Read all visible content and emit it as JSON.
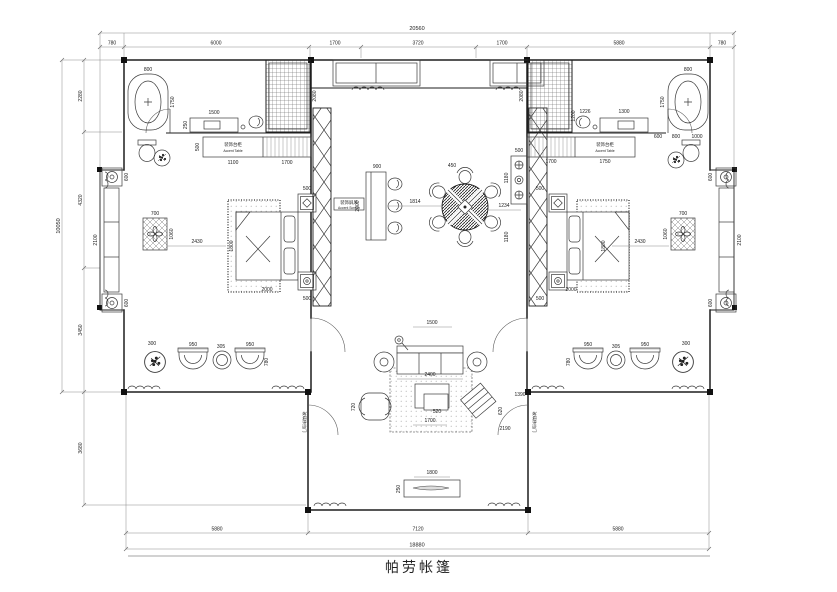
{
  "title": "帕劳帐篷",
  "dimensions": {
    "top_total": "20560",
    "top_segments": [
      "780",
      "6000",
      "1700",
      "3720",
      "1700",
      "5880",
      "780"
    ],
    "bottom_segments": [
      "5880",
      "7120",
      "5880"
    ],
    "bottom_total": "18880",
    "left_segments": [
      "2280",
      "4320",
      "3450",
      "3680"
    ],
    "left_total": "10050"
  },
  "labels": {
    "accent_table_cn": "装饰台柜",
    "accent_table_en": "Accent Table",
    "accent_screen_cn": "装饰屏风",
    "accent_screen_en": "Accent Screen",
    "glass_door": "玻璃移拉门"
  },
  "plan_dims": [
    "800",
    "1750",
    "1500",
    "250",
    "1100",
    "1700",
    "500",
    "2080",
    "700",
    "1060",
    "2430",
    "1800",
    "2000",
    "500",
    "500",
    "2100",
    "600",
    "600",
    "950",
    "305",
    "950",
    "780",
    "300",
    "900",
    "2000",
    "1814",
    "450",
    "1234",
    "500",
    "1180",
    "1180",
    "1500",
    "2400",
    "520",
    "1700",
    "620",
    "1390",
    "2190",
    "720",
    "1800",
    "250",
    "2080",
    "1226",
    "1300",
    "800",
    "1750",
    "1700",
    "1750",
    "600",
    "800",
    "1000",
    "1200",
    "500",
    "500",
    "700",
    "1060",
    "2430",
    "2000",
    "1800",
    "2100",
    "600",
    "600",
    "950",
    "305",
    "950",
    "780",
    "300"
  ],
  "colors": {
    "line": "#1e1e1e",
    "dim": "#8a8a8a",
    "bg": "#ffffff"
  }
}
